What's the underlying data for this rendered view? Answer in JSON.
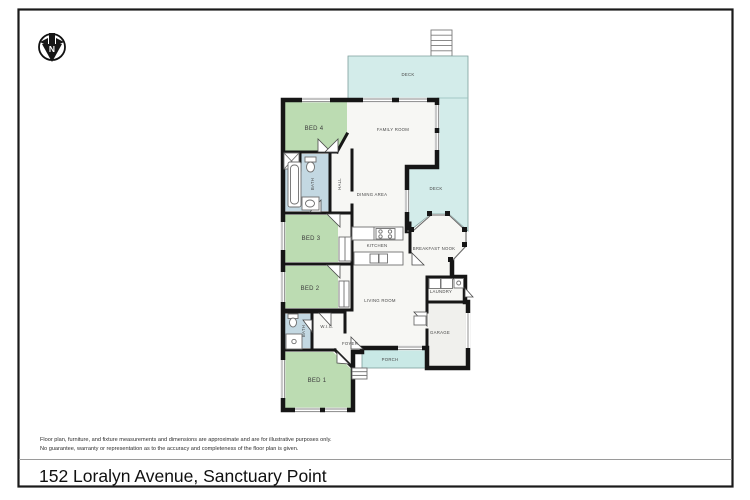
{
  "title_bar": {
    "address": "152 Loralyn Avenue, Sanctuary Point"
  },
  "disclaimer": {
    "line1": "Floor plan, furniture, and fixture measurements and dimensions are approximate and are for illustrative purposes only.",
    "line2": "No guarantee, warranty or representation as to the accuracy and completeness of the floor plan is given."
  },
  "compass": {
    "letter": "N"
  },
  "rooms": {
    "deck_top": {
      "label": "DECK"
    },
    "deck_side": {
      "label": "DECK"
    },
    "family_room": {
      "label": "FAMILY ROOM"
    },
    "bed4": {
      "label": "BED 4"
    },
    "bath_main": {
      "label": "BATH"
    },
    "hall": {
      "label": "HALL"
    },
    "dining": {
      "label": "DINING AREA"
    },
    "bed3": {
      "label": "BED 3"
    },
    "kitchen": {
      "label": "KITCHEN"
    },
    "breakfast_nook": {
      "label": "BREAKFAST NOOK"
    },
    "bed2": {
      "label": "BED 2"
    },
    "living": {
      "label": "LIVING ROOM"
    },
    "laundry": {
      "label": "LAUNDRY"
    },
    "bath_ensuite": {
      "label": "BATH"
    },
    "wic": {
      "label": "W.I.C."
    },
    "bed1": {
      "label": "BED 1"
    },
    "foyer": {
      "label": "FOYER"
    },
    "porch": {
      "label": "PORCH"
    },
    "garage": {
      "label": "GARAGE"
    }
  },
  "colors": {
    "bedroom_green": "#bcdcb2",
    "deck_teal": "#d3ecea",
    "porch_teal": "#c9e9e6",
    "bath_blue": "#c3d8e2",
    "floor_white": "#f7f7f4",
    "garage_grey": "#f0f0ed",
    "wall_black": "#161616"
  }
}
